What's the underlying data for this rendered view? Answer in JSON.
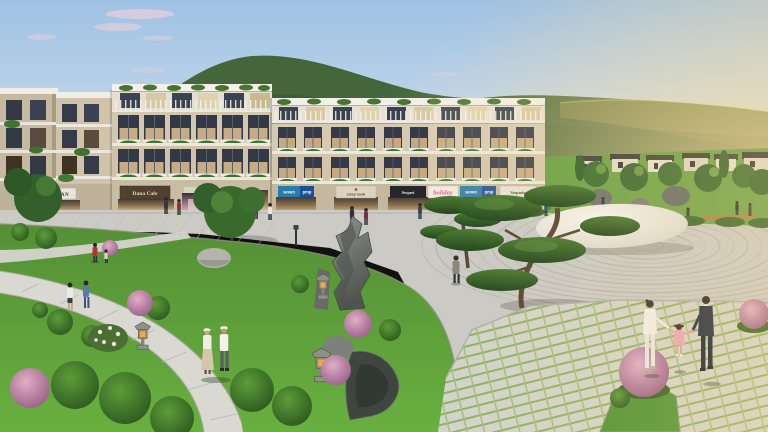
{
  "signs": {
    "jwan": "JWAN",
    "dana_cafe": "Dana Cafe",
    "seven_1": "seven",
    "pmp_1": "pmp",
    "cosy_look": "cosy look",
    "sequei": "Sequei",
    "holiday": "holiday",
    "seven_2": "seven",
    "pmp_2": "pmp",
    "sequoia": "Sequoia"
  },
  "colors": {
    "sky_top": "#9fc1e3",
    "sky_low": "#e3ebf1",
    "sun_glow": "#ffe2a8",
    "cloud": "#e5d0dc",
    "hill": "#44663a",
    "hill_right": "#3e6033",
    "lawn_top": "#558f36",
    "lawn_bottom": "#68b03f",
    "plaza": "#cbcac5",
    "zen_line": "#b1b0aa",
    "pebble": "#f8f6f0",
    "path": "#d9d8d1",
    "sign_dana": "#53412f",
    "sign_black": "#26262b",
    "sign_teal": "#2a7ca8",
    "sign_blue": "#1d4f94",
    "holiday_pink": "#d9559a",
    "suit_navy": "#222e40"
  }
}
